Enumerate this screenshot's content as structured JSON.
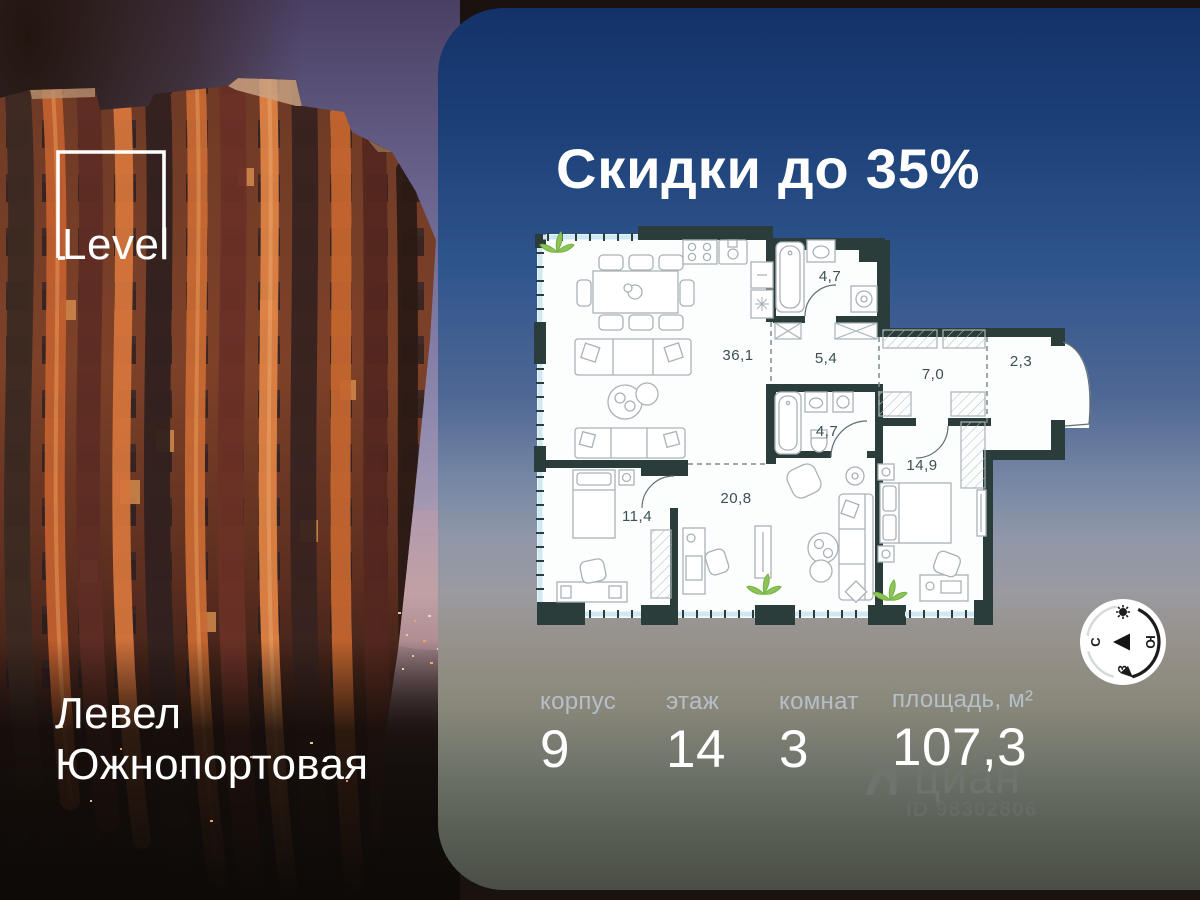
{
  "banner": {
    "headline": "Скидки до 35%"
  },
  "photo": {
    "logo_text": "Level",
    "project_line1": "Левел",
    "project_line2": "Южнопортовая"
  },
  "plan": {
    "rooms": [
      {
        "name": "kitchen-living",
        "area": "36,1"
      },
      {
        "name": "bathroom-top",
        "area": "4,7"
      },
      {
        "name": "corridor",
        "area": "5,4"
      },
      {
        "name": "hallway",
        "area": "7,0"
      },
      {
        "name": "entry",
        "area": "2,3"
      },
      {
        "name": "bathroom-bottom",
        "area": "4,7"
      },
      {
        "name": "bedroom-right",
        "area": "14,9"
      },
      {
        "name": "living-room",
        "area": "20,8"
      },
      {
        "name": "bedroom-left",
        "area": "11,4"
      }
    ]
  },
  "stats": {
    "items": [
      {
        "label": "корпус",
        "value": "9"
      },
      {
        "label": "этаж",
        "value": "14"
      },
      {
        "label": "комнат",
        "value": "3"
      },
      {
        "label": "площадь, м²",
        "value": "107,3"
      }
    ]
  },
  "compass": {
    "north": "С",
    "south": "Ю",
    "west": "З"
  },
  "watermark": {
    "brand": "циан",
    "listing_id": "ID 98302806"
  },
  "colors": {
    "panel_top": "#14326a",
    "panel_bottom": "#4a4e44",
    "plan_wall": "#2b3d3b",
    "plan_glazing": "#cfe9f4",
    "plan_label": "#3c5053",
    "plant_green": "#76b143",
    "text_primary": "#ffffff",
    "label_muted": "#b5bfc9",
    "building_orange": "#c4662f"
  }
}
